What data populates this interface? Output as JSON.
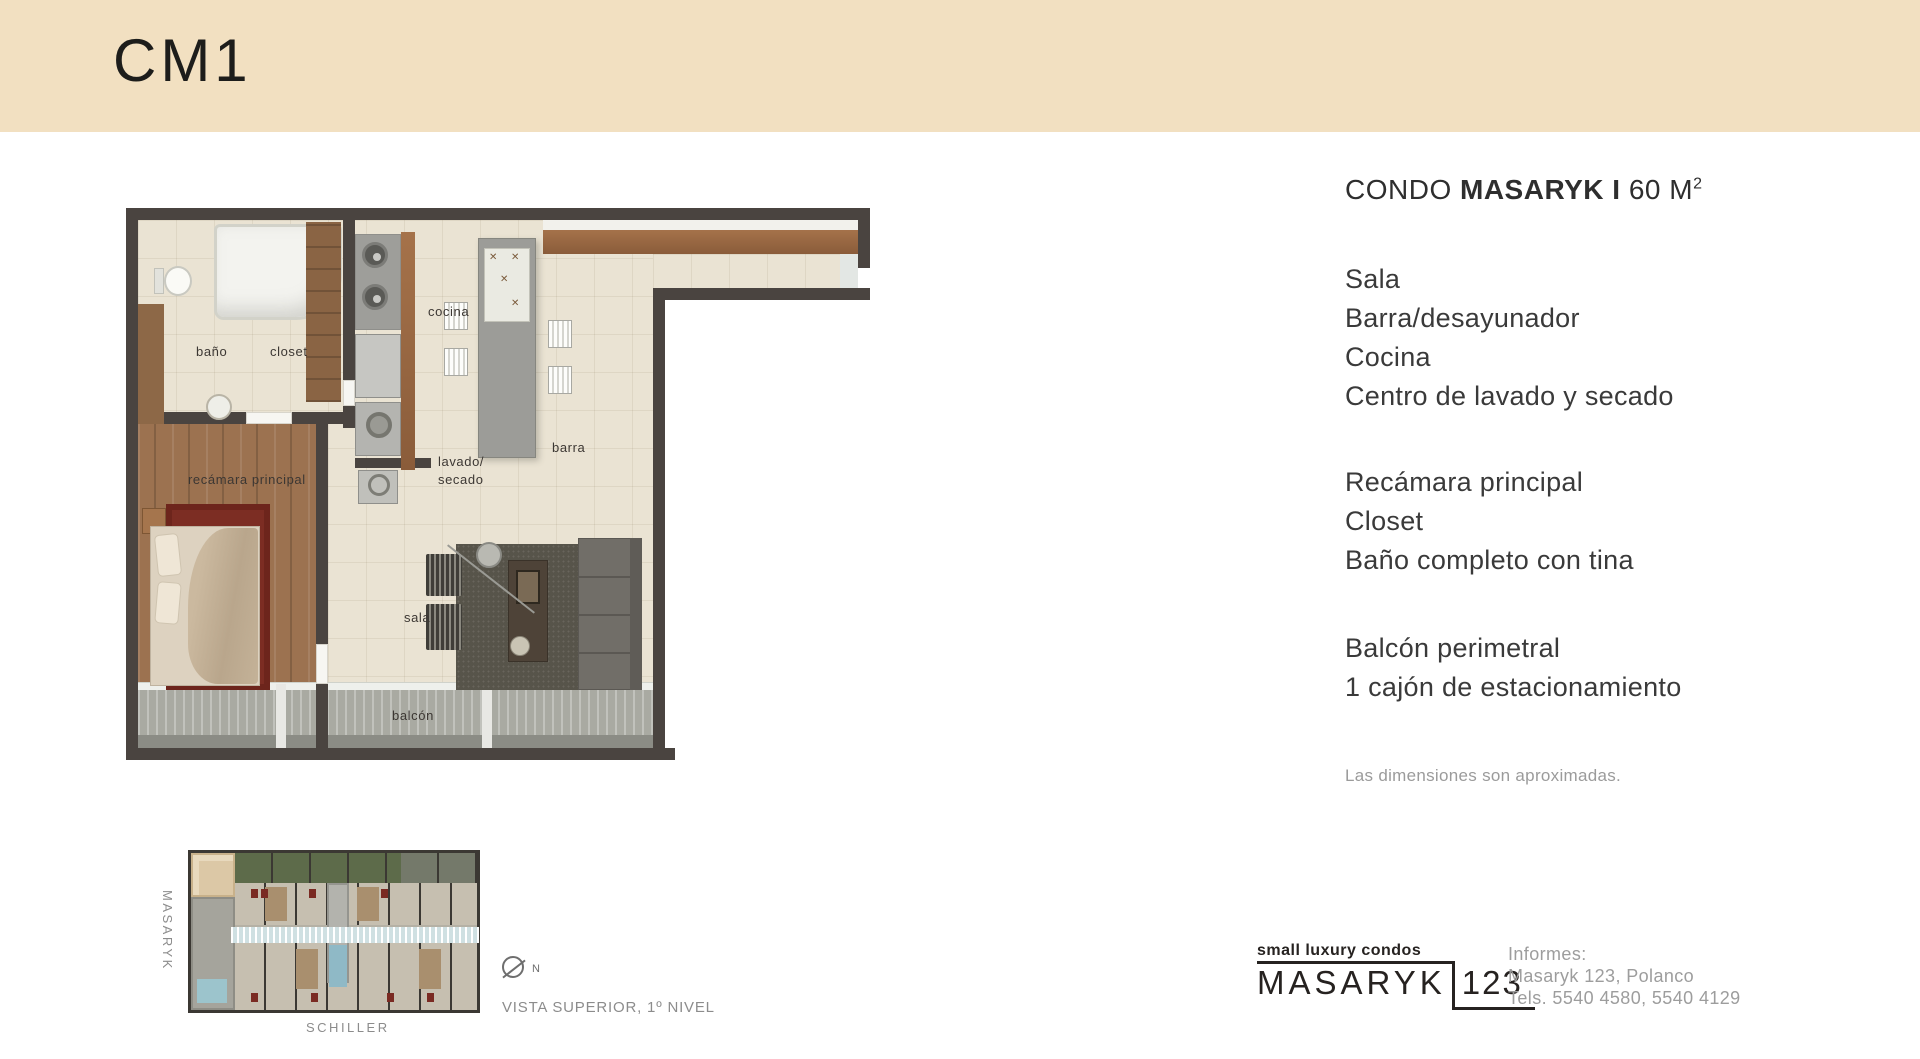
{
  "page": {
    "unit_code": "CM1"
  },
  "details": {
    "title": {
      "prefix": "CONDO ",
      "brand": "MASARYK I ",
      "area": "60 M",
      "area_sup": "2"
    },
    "groups": [
      [
        "Sala",
        "Barra/desayunador",
        "Cocina",
        "Centro de lavado y secado"
      ],
      [
        "Recámara principal",
        "Closet",
        "Baño completo con tina"
      ],
      [
        "Balcón perimetral",
        "1 cajón de estacionamiento"
      ]
    ],
    "disclaimer": "Las dimensiones son aproximadas."
  },
  "floorplan": {
    "labels": {
      "bano": "baño",
      "closet": "closet",
      "cocina": "cocina",
      "lavado_line1": "lavado/",
      "lavado_line2": "secado",
      "barra": "barra",
      "recamara": "recámara principal",
      "sala": "sala",
      "balcon": "balcón"
    }
  },
  "siteplan": {
    "street_left": "MASARYK",
    "street_bottom": "SCHILLER",
    "north_label": "N",
    "caption": "VISTA SUPERIOR,  1º NIVEL"
  },
  "footer": {
    "logo_tagline": "small luxury condos",
    "logo_name": "MASARYK",
    "logo_number": "123",
    "contact": [
      "Informes:",
      "Masaryk 123, Polanco",
      "Tels. 5540 4580, 5540 4129"
    ]
  },
  "colors": {
    "banner": "#f2e0c1",
    "wall": "#4a4440",
    "accent_red": "#7c2d23",
    "marble": "#eae3d3",
    "wood": "#9c7250",
    "text_dark": "#2f2b28",
    "text_gray": "#9b9b9b"
  }
}
